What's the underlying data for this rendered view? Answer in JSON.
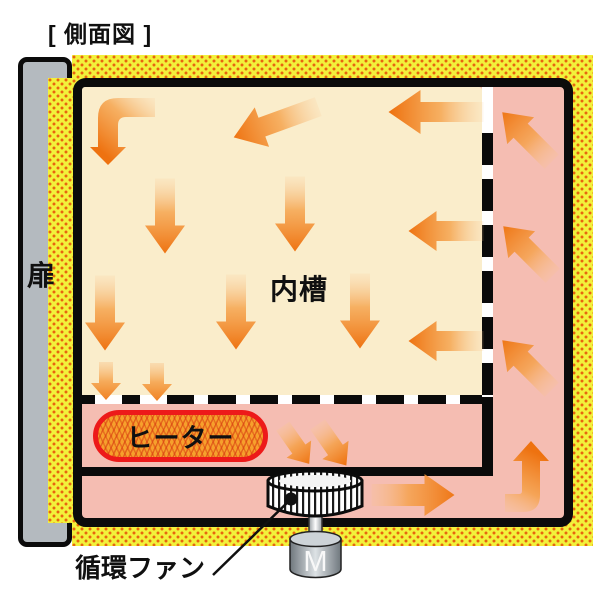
{
  "title": "[ 側面図 ]",
  "labels": {
    "door": "扉",
    "inner_chamber": "内槽",
    "heater": "ヒーター",
    "circulation_fan": "循環ファン",
    "motor": "M"
  },
  "colors": {
    "insulation_yellow": "#F2F13B",
    "insulation_dot_orange": "#E8640F",
    "airflow_duct_pink": "#F5BDB2",
    "chamber_cream": "#FAEDCB",
    "arrow_orange": "#EE7210",
    "heater_fill_orange": "#F6A02C",
    "heater_border_red": "#ED1A1A",
    "door_gray": "#B4BABF",
    "outline_black": "#0B0B0B"
  },
  "flow_arrows": [
    {
      "area": "inner-chamber",
      "direction": "elbow-left-then-down"
    },
    {
      "area": "inner-chamber",
      "direction": "down-left"
    },
    {
      "area": "inner-chamber",
      "direction": "left"
    },
    {
      "area": "inner-chamber",
      "direction": "down"
    },
    {
      "area": "inner-chamber",
      "direction": "down"
    },
    {
      "area": "inner-chamber",
      "direction": "left"
    },
    {
      "area": "inner-chamber",
      "direction": "down"
    },
    {
      "area": "inner-chamber",
      "direction": "down"
    },
    {
      "area": "inner-chamber",
      "direction": "down"
    },
    {
      "area": "inner-chamber",
      "direction": "left"
    },
    {
      "area": "chamber-outlet",
      "direction": "down-small"
    },
    {
      "area": "chamber-outlet",
      "direction": "down-small"
    },
    {
      "area": "heater-compartment",
      "direction": "down-right"
    },
    {
      "area": "heater-compartment",
      "direction": "down-right"
    },
    {
      "area": "bottom-duct",
      "direction": "right"
    },
    {
      "area": "bottom-duct",
      "direction": "elbow-right-then-up"
    },
    {
      "area": "right-duct",
      "direction": "up-left"
    },
    {
      "area": "right-duct",
      "direction": "up-left"
    },
    {
      "area": "right-duct",
      "direction": "up-left"
    }
  ]
}
